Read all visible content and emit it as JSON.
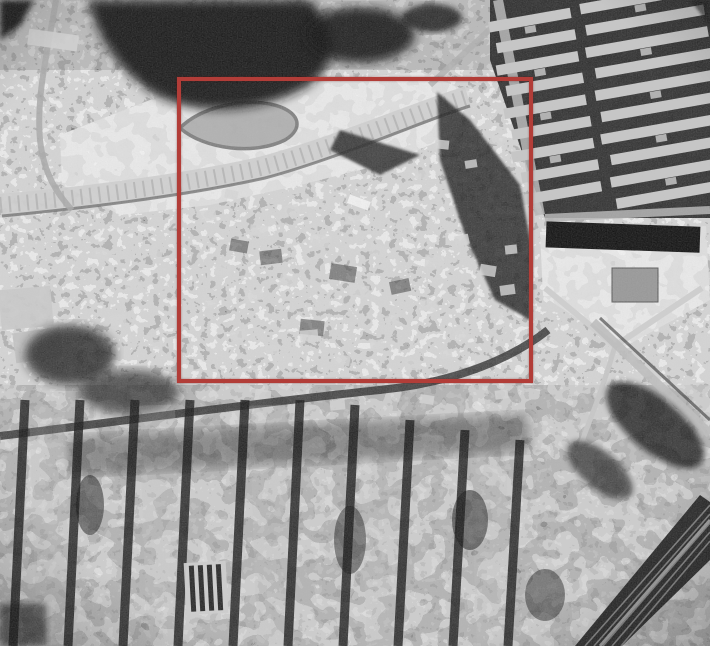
{
  "meta": {
    "type": "aerial-photograph",
    "style": "black-and-white vertical aerial photo, grainy monochrome print",
    "subject": "Dense urban district photographed from directly above (Kowloon Walled City area)",
    "description": "Monochrome aerial photograph of a packed city: terraced cleared ground with a curved road at the upper left, rows of long resettlement housing slabs at the upper right, an irregular mass of tiny tightly-packed rooftops in the centre outlined by a red rectangle, a walled compound with a V-shaped road junction at mid right, a regular grid of tenement blocks and dark streets across the lower half, and a diagonal rail corridor at the lower right corner."
  },
  "palette": {
    "photo_light": "#c9c9c9",
    "photo_mid": "#8a8a8a",
    "photo_dark": "#1a1a1a",
    "annotation_red": "#b23d38"
  },
  "annotation": {
    "name": "highlight-rectangle",
    "shape": "rectangle",
    "color": "#b23d38",
    "border_px": 4,
    "x": 177,
    "y": 77,
    "width": 356,
    "height": 306,
    "box_style": "left:177px;top:77px;width:356px;height:306px;border:4px solid #b23d38;"
  },
  "regions": [
    {
      "name": "hill-shadow-top",
      "desc": "dark vegetated hillside mass along the upper edge"
    },
    {
      "name": "terraced-clearing",
      "desc": "light cleared/terraced ground with a sweeping curved road, upper left inside the red box"
    },
    {
      "name": "estate-blocks",
      "desc": "parallel rows of long light housing slabs with black shadows, upper right"
    },
    {
      "name": "walled-city-core",
      "desc": "irregular dense small rooftops highlighted by the red rectangle"
    },
    {
      "name": "compound-with-v-roads",
      "desc": "walled compound and V-shaped road junction, middle right"
    },
    {
      "name": "street-grid",
      "desc": "regular tenement grid with dark vertical streets, lower half"
    },
    {
      "name": "rail-corridor",
      "desc": "diagonal railway band, bottom right corner"
    },
    {
      "name": "market-sheds",
      "desc": "small striped shed roofs in the lower-left grid"
    }
  ]
}
